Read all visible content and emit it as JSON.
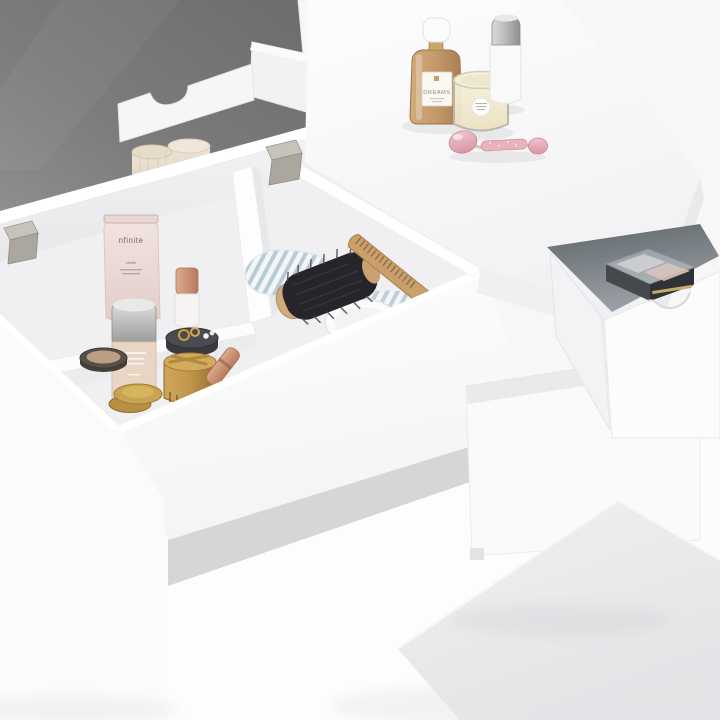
{
  "image": {
    "type": "3d-product-photo",
    "subject": "White vanity dressing table with flip-up mirror lid, divided storage compartments filled with cosmetics, an open side drawer and a matching stool",
    "background_color": "#f6f6f7"
  },
  "furniture": {
    "body_color": "#ffffff",
    "mirror_color": "#787878",
    "hinge_color": "#b5b1a9",
    "stretcher_color": "#d6d6d8",
    "parts": [
      {
        "name": "mirror-lid",
        "desc": "flip-up lid with inset mirror, raised"
      },
      {
        "name": "organizer-tray",
        "desc": "white back tray with scalloped cut-out"
      },
      {
        "name": "storage-box",
        "desc": "open-top storage with divider walls"
      },
      {
        "name": "tabletop",
        "desc": "fixed right half of the tabletop"
      },
      {
        "name": "side-drawer",
        "desc": "open drawer with curved cut-out handle"
      },
      {
        "name": "drawer-cabinet",
        "desc": "drawer pedestal cabinet"
      },
      {
        "name": "left-leg-panel",
        "desc": "left side leg panel"
      },
      {
        "name": "stool",
        "desc": "white stool at lower right"
      }
    ]
  },
  "labels": {
    "perfume_brand": "DREAMS",
    "tube_brand": "nfinite"
  },
  "items": {
    "tabletop": [
      {
        "name": "perfume-bottle",
        "label": "DREAMS",
        "glass_color": "#c3996a",
        "cap_color": "#fbfbfc"
      },
      {
        "name": "scented-candle",
        "wax_color": "#f2ead0",
        "label_color": "#fdfdfb"
      },
      {
        "name": "spray-bottle",
        "body_color": "#f9f9fa",
        "cap_color": "#b9b8b6"
      },
      {
        "name": "rose-quartz-face-roller",
        "stone_color": "#e7aeba"
      }
    ],
    "compartments": [
      {
        "name": "cream-tube",
        "label": "nfinite",
        "color": "#eddbd8"
      },
      {
        "name": "dropper-bottle",
        "cap_color": "#c28a6d"
      },
      {
        "name": "small-cream-jars",
        "count": 2,
        "color": "#e7dccb"
      },
      {
        "name": "striped-towel",
        "colors": [
          "#ffffff",
          "#b9cbd7"
        ]
      },
      {
        "name": "round-hair-brush",
        "bristle_color": "#26262a",
        "wood_color": "#d2a97c"
      },
      {
        "name": "wooden-comb",
        "color": "#c9a06b"
      },
      {
        "name": "white-dish",
        "color": "#fbfbfc"
      },
      {
        "name": "foundation-bottle",
        "fluid_color": "#e8d5c3",
        "cap_color": "#c6c6c4"
      },
      {
        "name": "powder-compact",
        "lid_color": "#57504a",
        "powder_color": "#bb9f83"
      },
      {
        "name": "jar-with-rings-and-pearls",
        "ring_color": "#c9a13c",
        "pearl_color": "#f4f1ec"
      },
      {
        "name": "gold-tin-with-tools",
        "color": "#c0964d"
      },
      {
        "name": "gold-compacts",
        "count": 2,
        "color": "#c9a353"
      },
      {
        "name": "lipstick",
        "color": "#cf9478"
      }
    ],
    "drawer": [
      {
        "name": "eyeshadow-palette",
        "case_color": "#33383c",
        "pan_colors": [
          "#c7c9cb",
          "#d8b4a4"
        ],
        "lid": "clear"
      }
    ]
  }
}
